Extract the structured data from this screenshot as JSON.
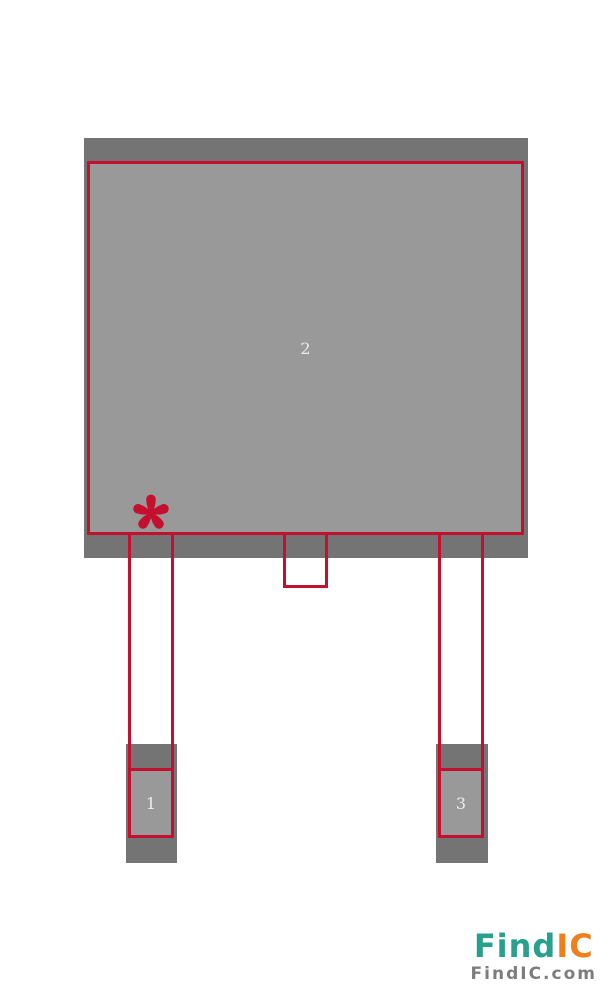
{
  "footprint": {
    "pads": [
      {
        "number": "1"
      },
      {
        "number": "2"
      },
      {
        "number": "3"
      }
    ],
    "pin1_marker_icon": "asterisk-icon"
  },
  "branding": {
    "logo_primary": "Find",
    "logo_secondary": "IC",
    "website": "FindIC.com"
  },
  "colors": {
    "outline_red": "#c4102f",
    "pad_dark_gray": "#747474",
    "pad_light_gray": "#999999",
    "pin_label": "#ececec",
    "logo_teal": "#28a08e",
    "logo_orange": "#f07e1b",
    "logo_gray": "#7d7d7d",
    "background": "#ffffff"
  }
}
